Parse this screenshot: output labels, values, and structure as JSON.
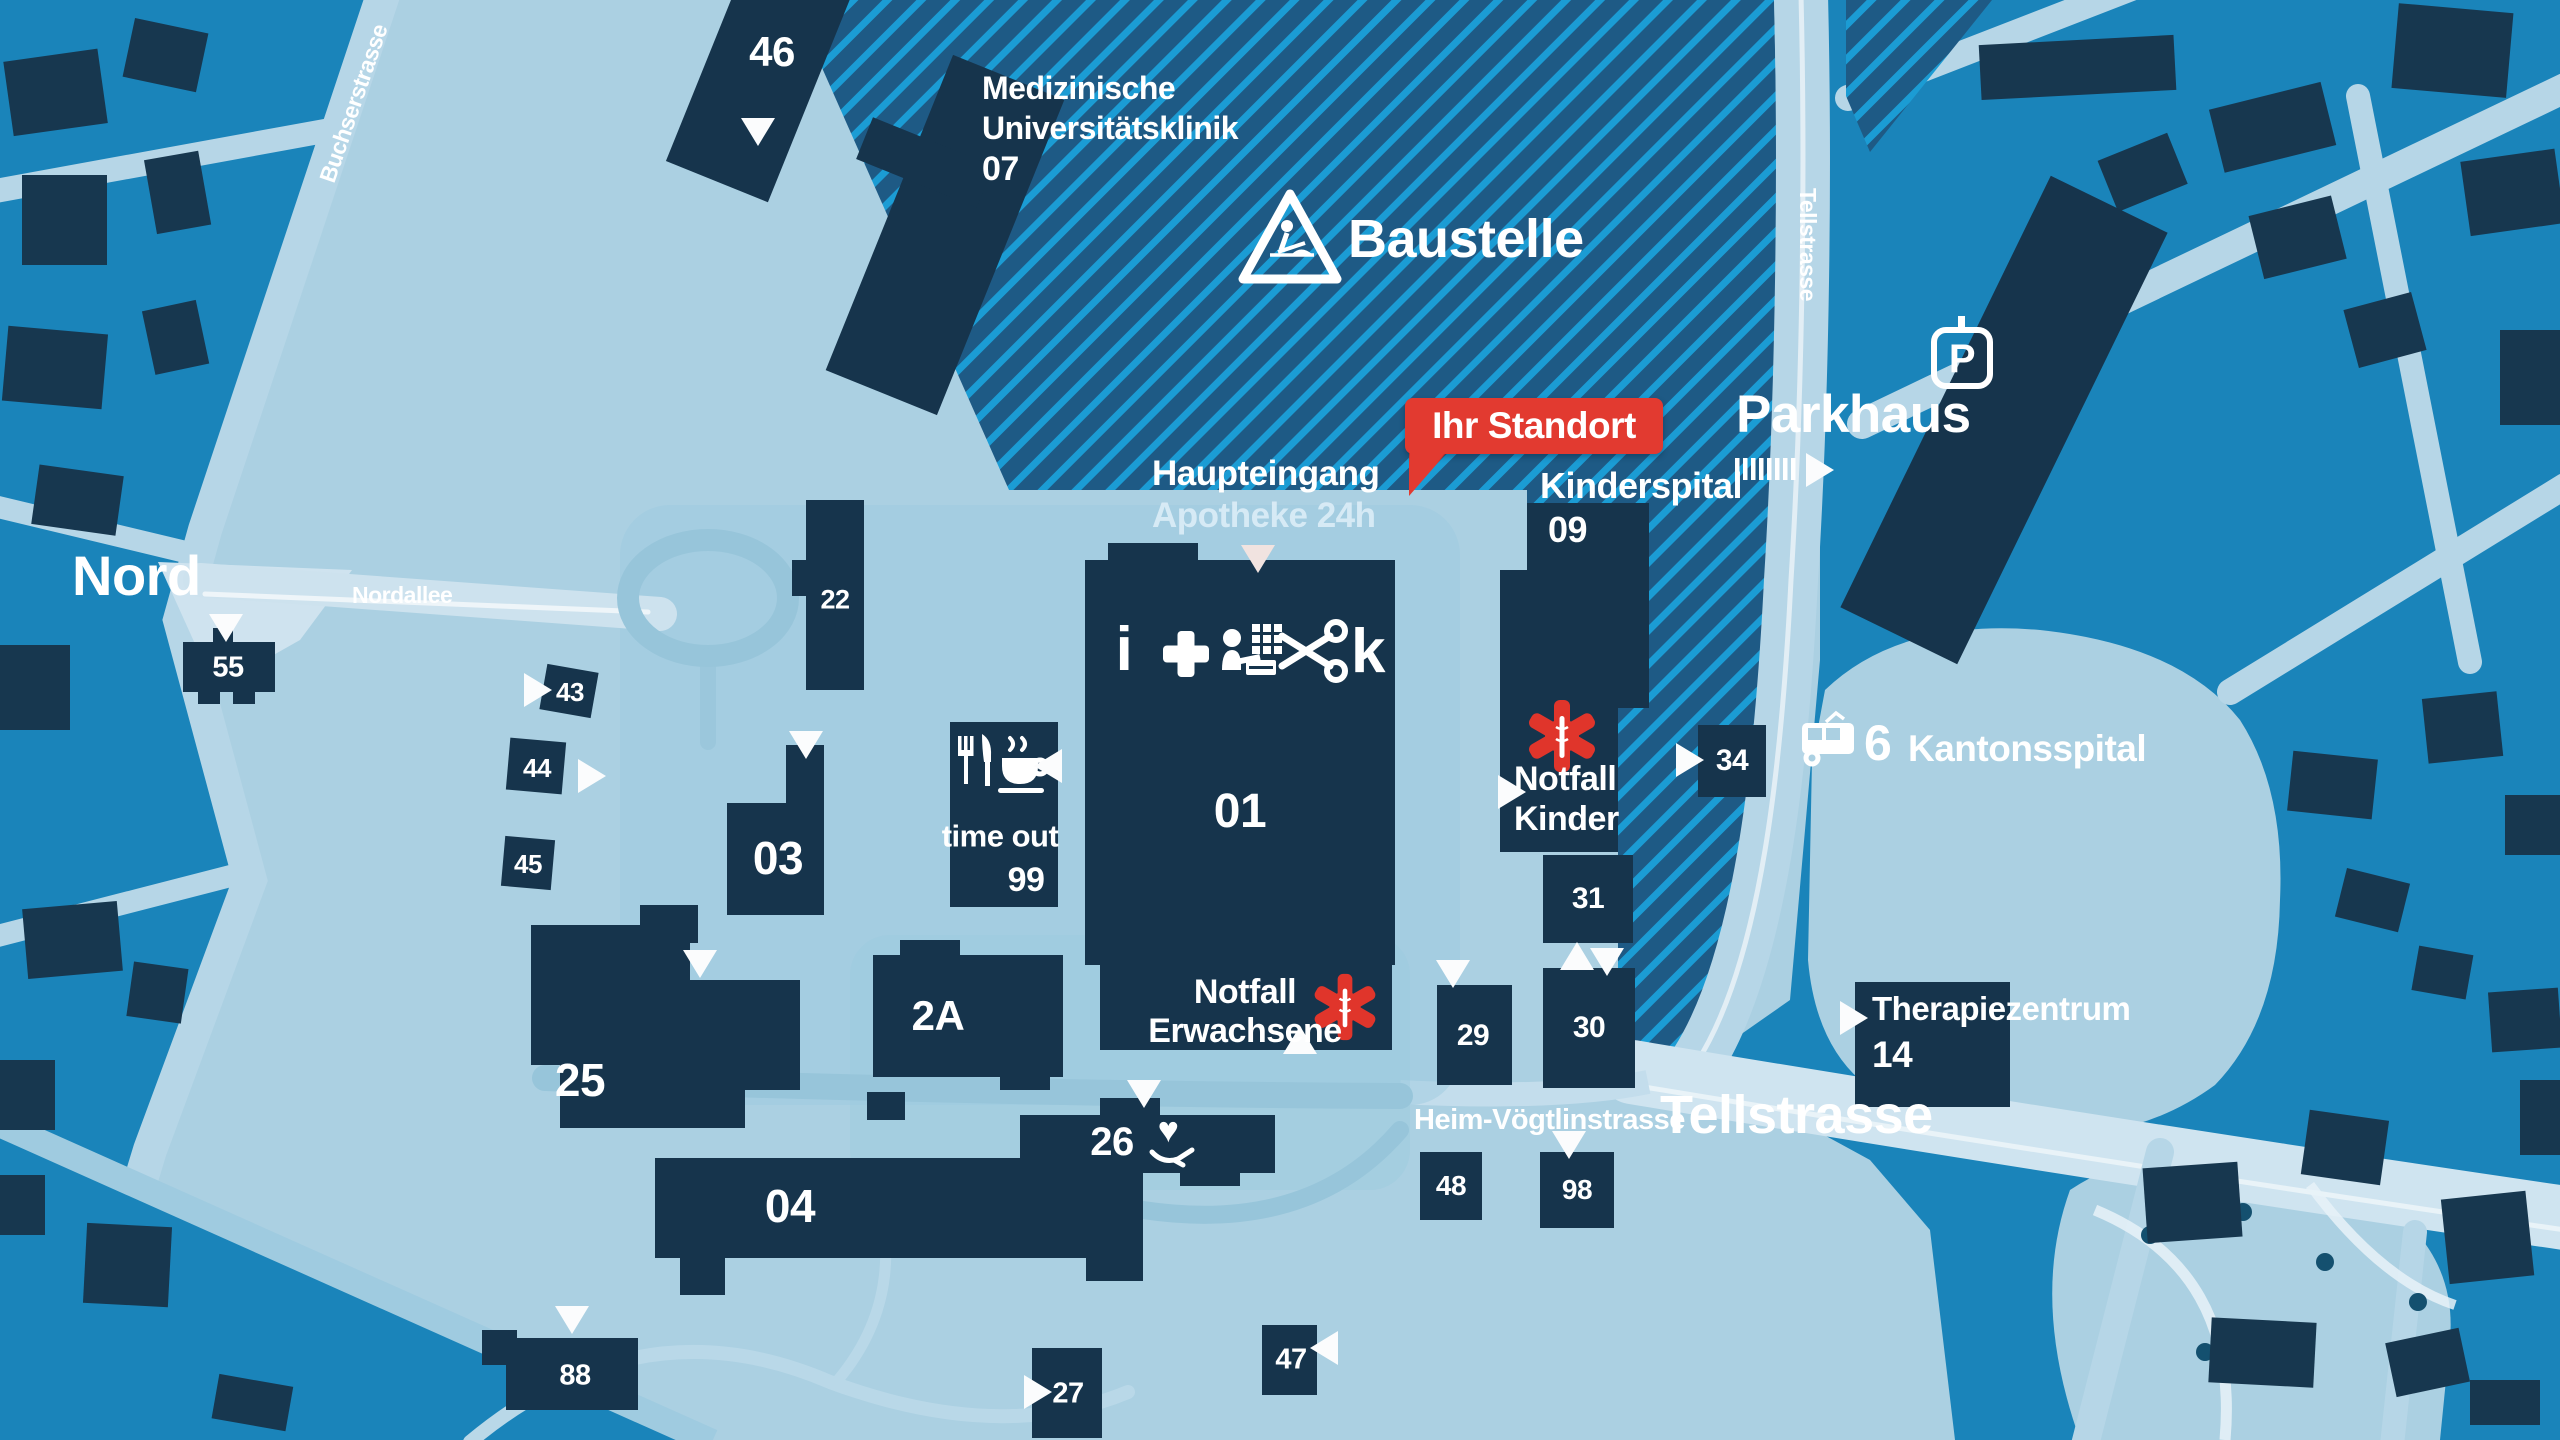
{
  "streets": {
    "buchserstrasse": "Buchserstrasse",
    "nord": "Nord",
    "nordallee": "Nordallee",
    "tellstrasse_top": "Tellstrasse",
    "tellstrasse_main": "Tellstrasse",
    "heim_voegtlinstrasse": "Heim-Vögtlinstrasse"
  },
  "labels": {
    "baustelle": "Baustelle",
    "ihr_standort": "Ihr Standort",
    "parkhaus": "Parkhaus",
    "haupteingang": "Haupteingang",
    "apotheke": "Apotheke 24h",
    "kinderspital": "Kinderspital",
    "therapiezentrum": "Therapiezentrum",
    "time_out": "time out",
    "kantonsspital": "Kantonsspital",
    "tram_line": "6",
    "parking": "P",
    "info": "i",
    "kiosk": "k",
    "med_klinik": {
      "l1": "Medizinische",
      "l2": "Universitätsklinik"
    },
    "notfall_kinder": {
      "l1": "Notfall",
      "l2": "Kinder"
    },
    "notfall_erwachsene": {
      "l1": "Notfall",
      "l2": "Erwachsene"
    }
  },
  "buildings": {
    "b46": "46",
    "b07": "07",
    "b22": "22",
    "b55": "55",
    "b43": "43",
    "b44": "44",
    "b45": "45",
    "b03": "03",
    "b99": "99",
    "b01": "01",
    "b2a": "2A",
    "b25": "25",
    "b04": "04",
    "b26": "26",
    "b88": "88",
    "b27": "27",
    "b47": "47",
    "b29": "29",
    "b30": "30",
    "b31": "31",
    "b34": "34",
    "b48": "48",
    "b98": "98",
    "b09": "09",
    "b14": "14"
  },
  "icons": {
    "heart": "♥"
  },
  "colors": {
    "city_blue": "#1a84ba",
    "campus_light": "#abd0e2",
    "building_dark": "#16344c",
    "hatch_base": "#1e5a85",
    "hatch_stripe": "#1b9cd4",
    "accent_red": "#e23a30",
    "road_light": "#cfe4f0",
    "text_white": "#ffffff"
  }
}
